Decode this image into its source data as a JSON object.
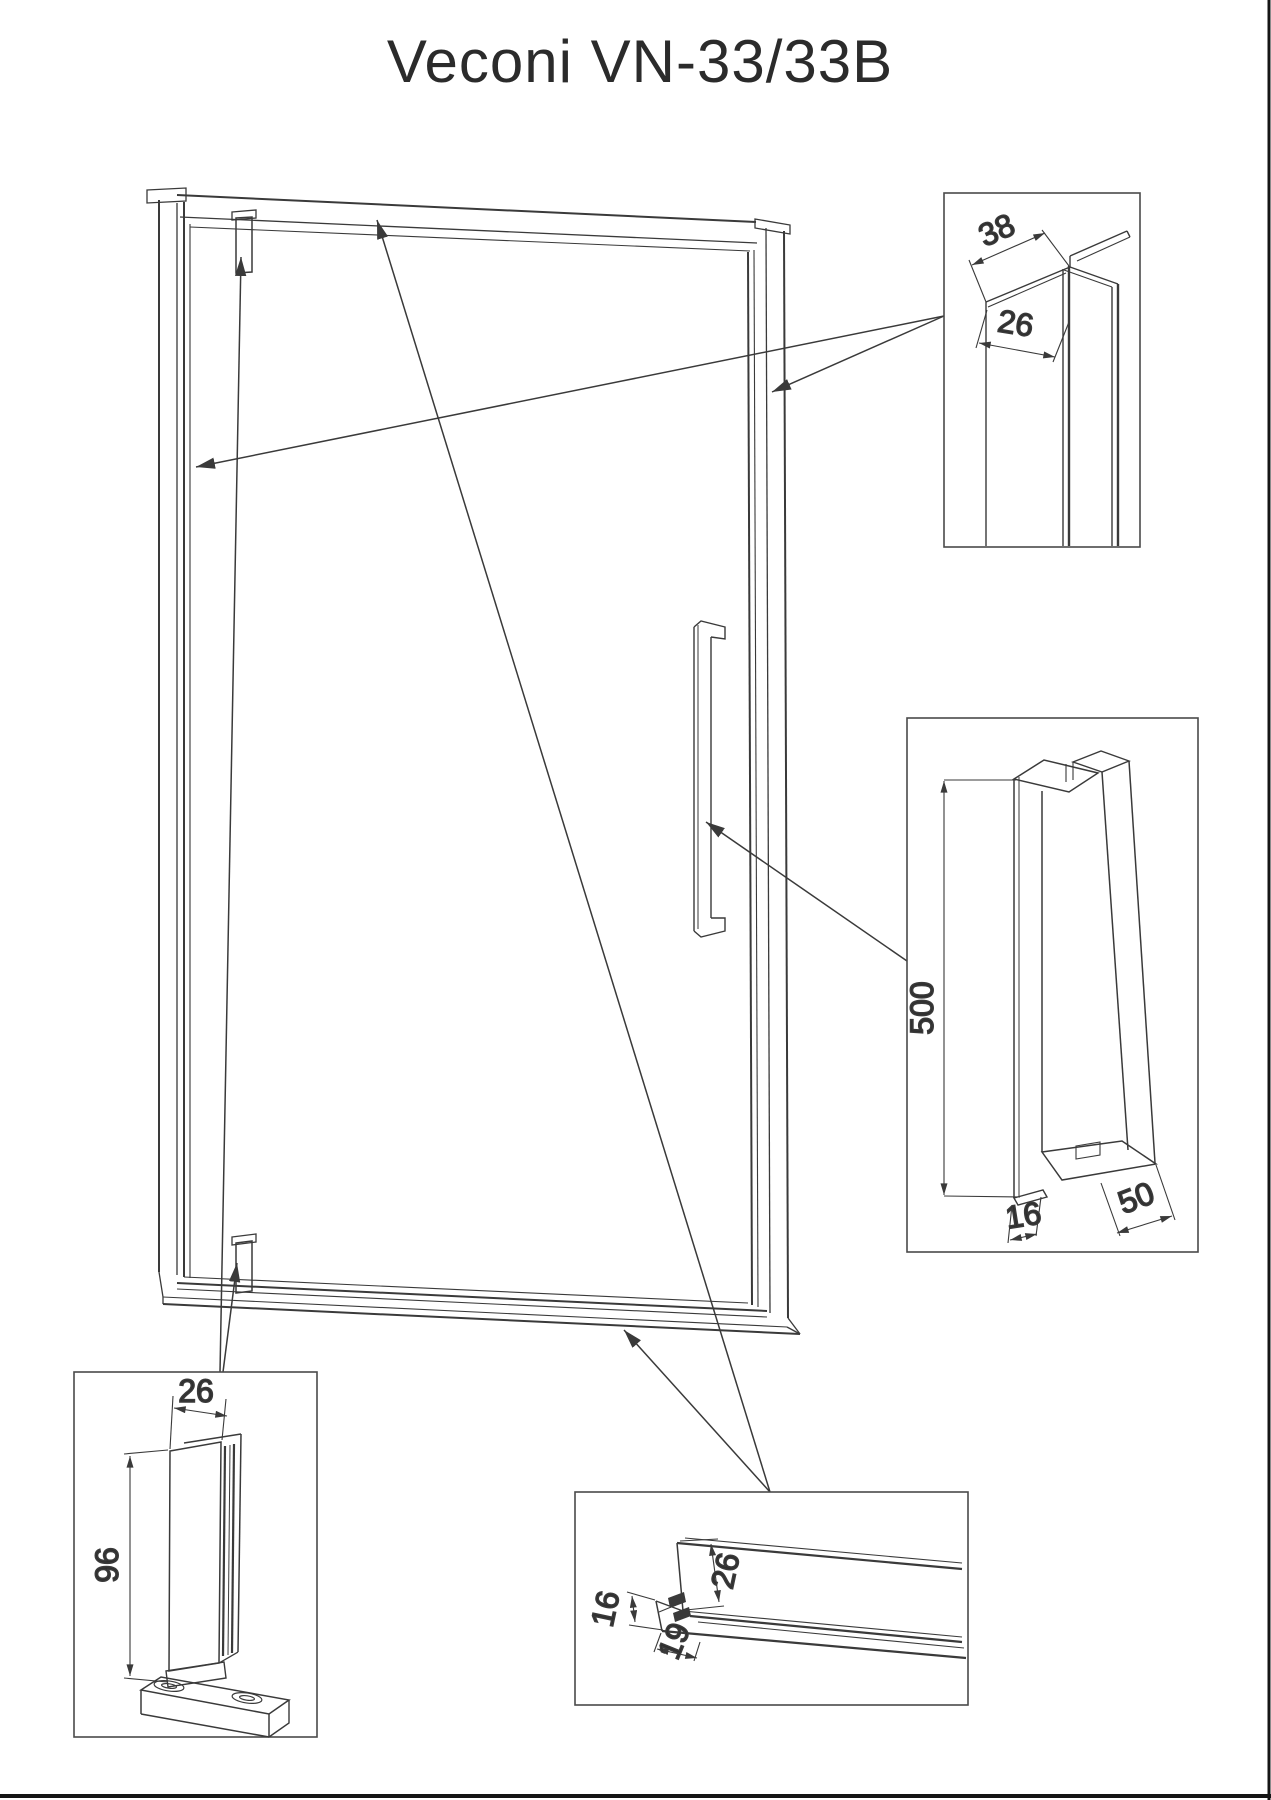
{
  "title": "Veconi VN-33/33B",
  "colors": {
    "line": "#3a3a3a",
    "box_border": "#4a4a4a",
    "background": "#ffffff",
    "sheet_edge": "#151515"
  },
  "details": {
    "wall_profile": {
      "dim_width": "38",
      "dim_depth": "26"
    },
    "handle": {
      "dim_length": "500",
      "dim_bar": "16",
      "dim_depth": "50"
    },
    "pivot_hinge": {
      "dim_width": "26",
      "dim_height": "96"
    },
    "bottom_profile": {
      "dim_height": "26",
      "dim_base_height": "16",
      "dim_base_depth": "19"
    }
  }
}
